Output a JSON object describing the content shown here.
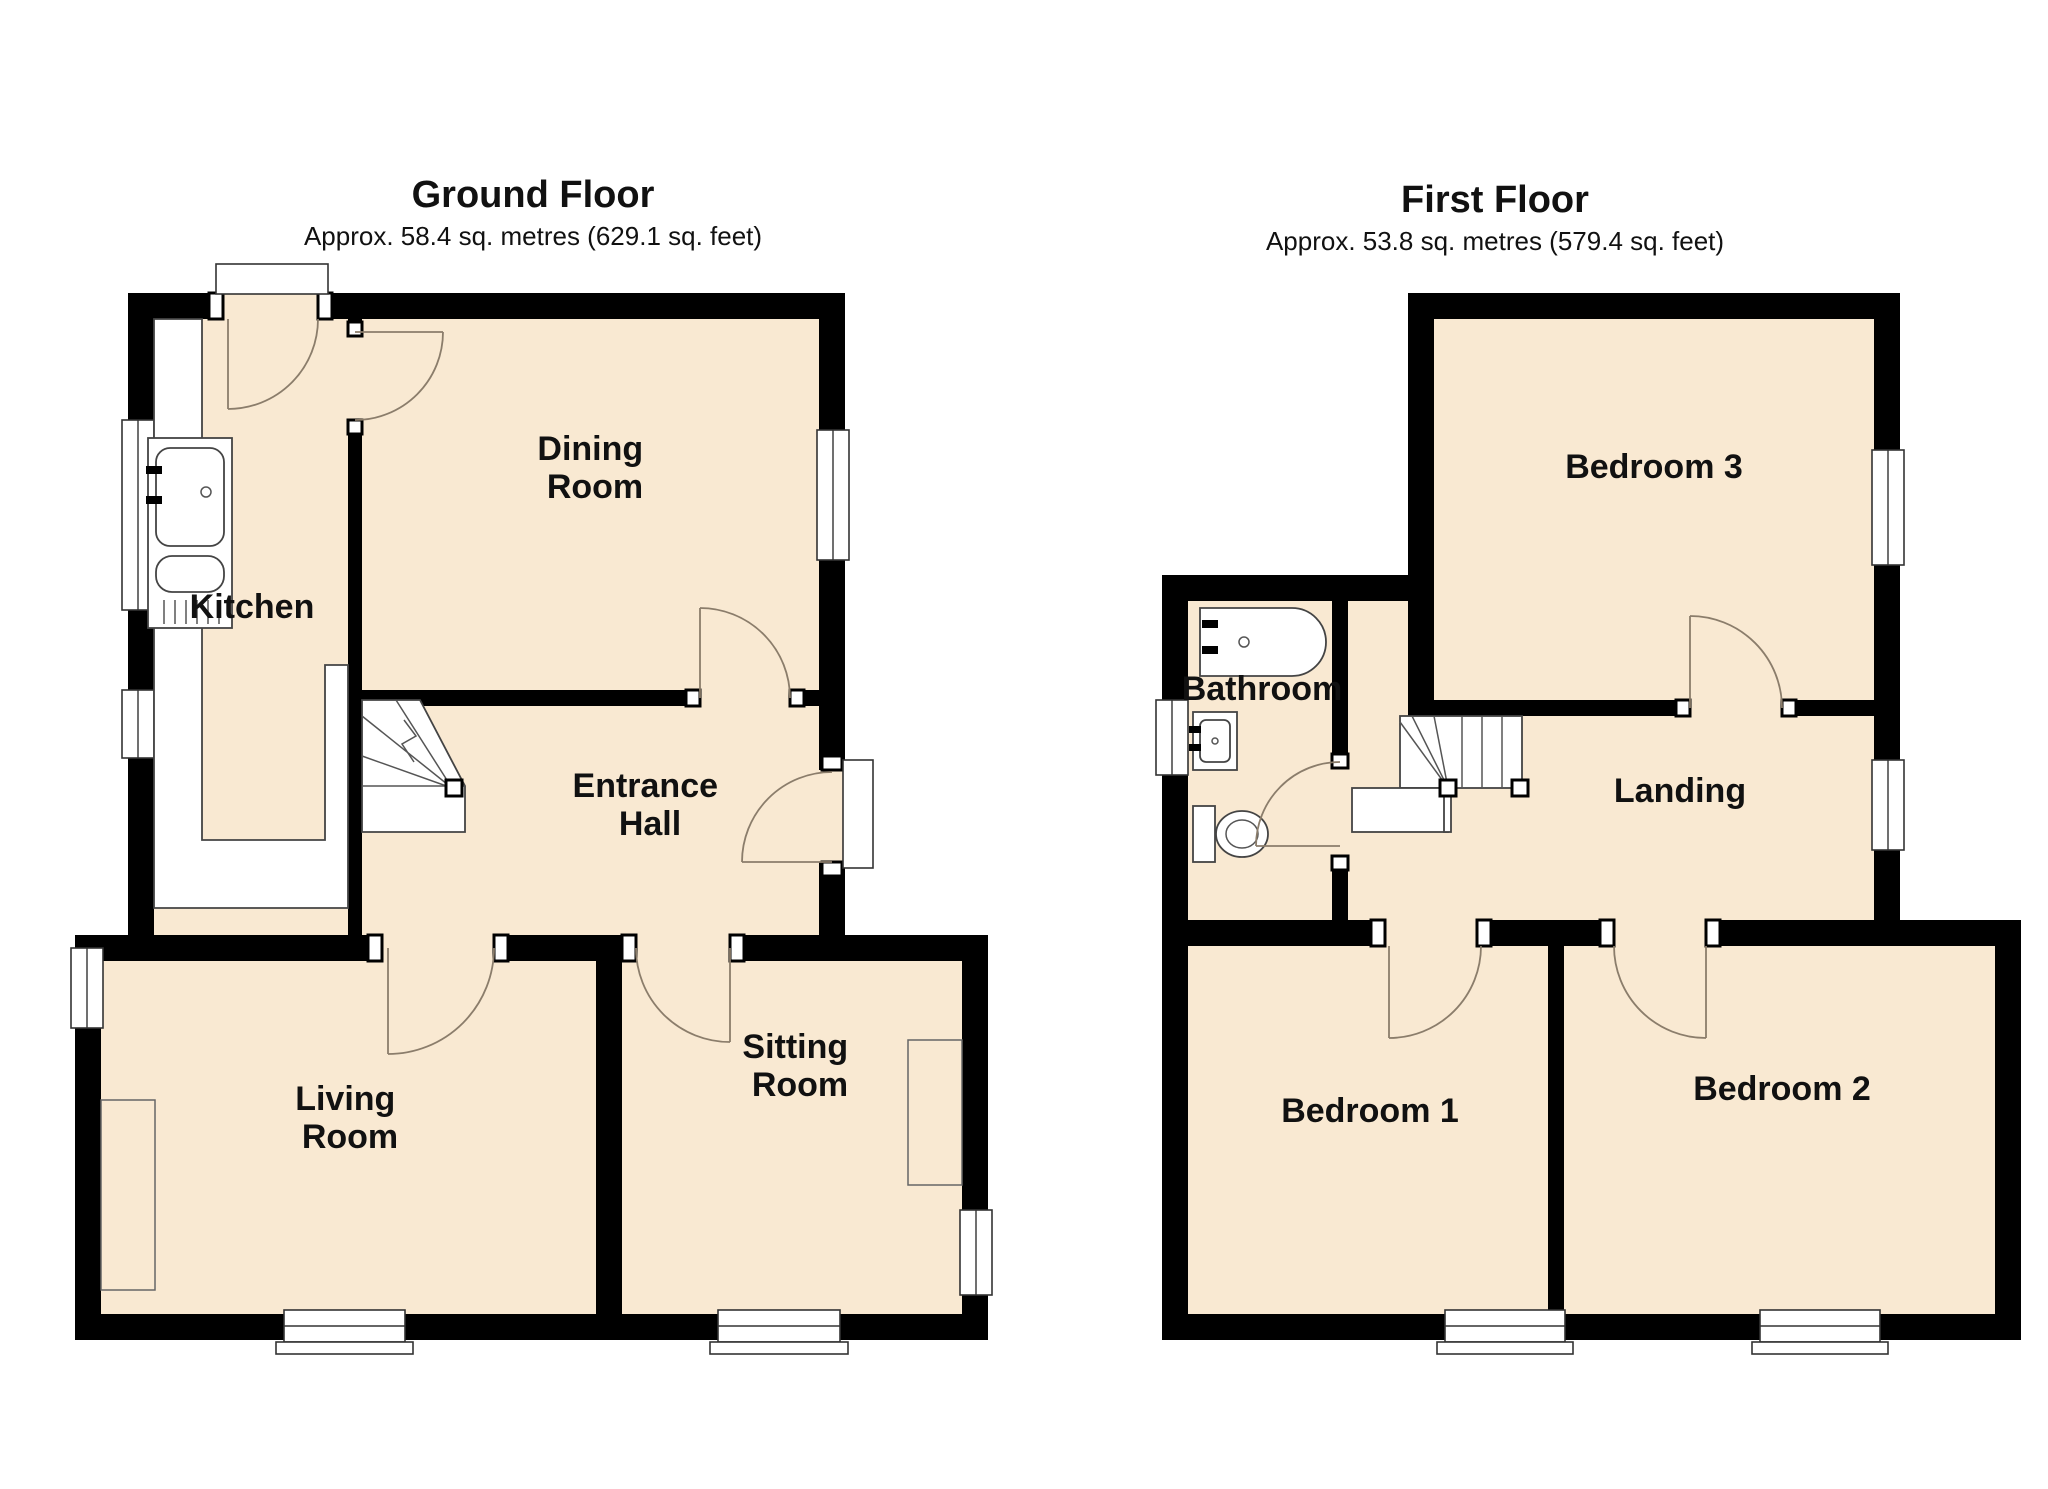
{
  "page": {
    "background": "#ffffff"
  },
  "colors": {
    "floor_fill": "#F9E9D2",
    "wall": "#000000",
    "fixture_stroke": "#444444",
    "door_arc": "#8B7D6B",
    "text": "#111111"
  },
  "ground_floor": {
    "title": "Ground Floor",
    "subtitle": "Approx. 58.4 sq. metres (629.1 sq. feet)",
    "rooms": {
      "kitchen": {
        "label": "Kitchen"
      },
      "dining": {
        "label": "Dining Room",
        "lines": [
          "Dining",
          "Room"
        ]
      },
      "hall": {
        "label": "Entrance Hall",
        "lines": [
          "Entrance",
          "Hall"
        ]
      },
      "living": {
        "label": "Living Room",
        "lines": [
          "Living",
          "Room"
        ]
      },
      "sitting": {
        "label": "Sitting Room",
        "lines": [
          "Sitting",
          "Room"
        ]
      }
    }
  },
  "first_floor": {
    "title": "First Floor",
    "subtitle": "Approx. 53.8 sq. metres (579.4 sq. feet)",
    "rooms": {
      "bedroom3": {
        "label": "Bedroom 3"
      },
      "bathroom": {
        "label": "Bathroom"
      },
      "landing": {
        "label": "Landing"
      },
      "bedroom1": {
        "label": "Bedroom 1"
      },
      "bedroom2": {
        "label": "Bedroom 2"
      }
    }
  }
}
